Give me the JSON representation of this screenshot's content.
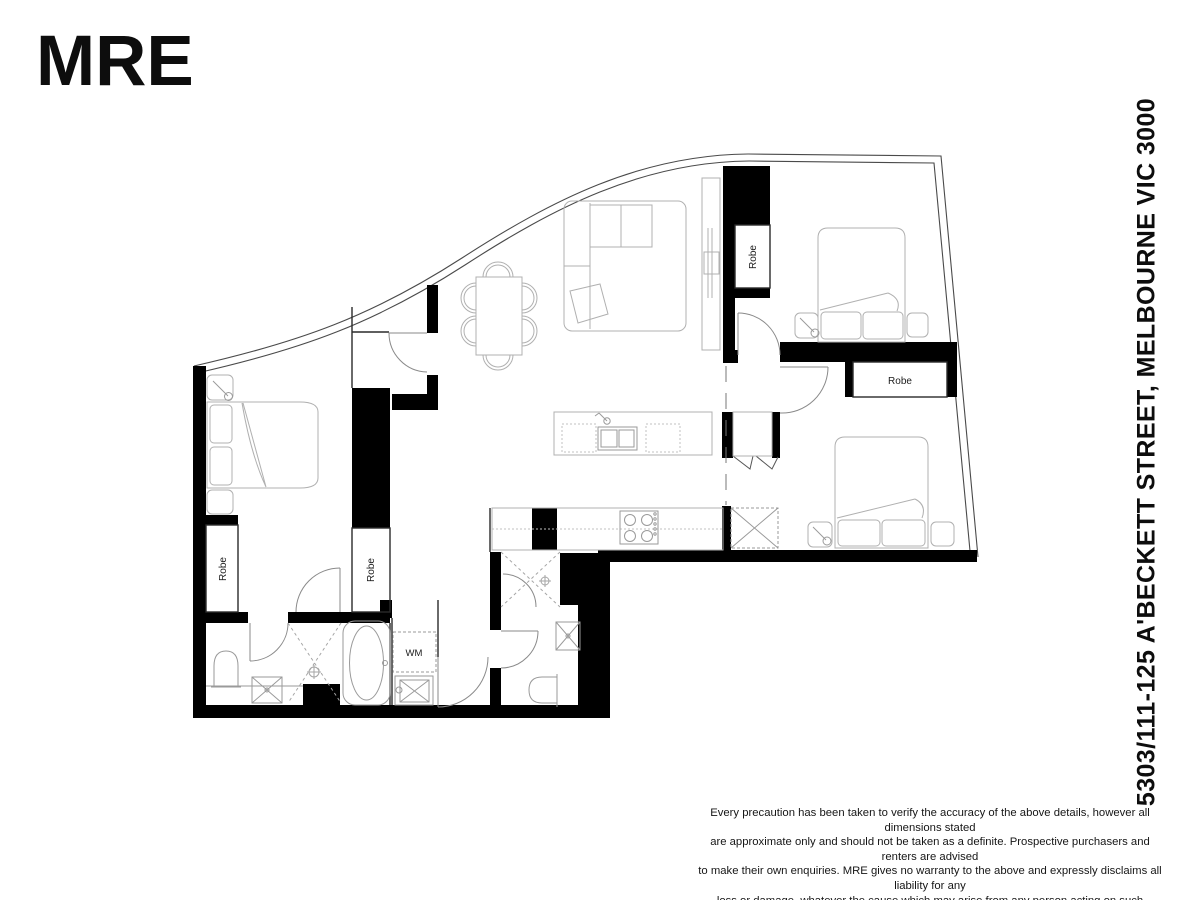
{
  "logo": {
    "text": "MRE"
  },
  "address": {
    "text": "5303/111-125 A'BECKETT STREET, MELBOURNE VIC 3000"
  },
  "floor_plan": {
    "labels": {
      "robe_top": "Robe",
      "robe_right": "Robe",
      "robe_left_outer": "Robe",
      "robe_left_inner": "Robe",
      "wm": "WM"
    }
  },
  "disclaimer": {
    "line1": "Every precaution has been taken to verify the accuracy of the above details, however all dimensions stated",
    "line2": "are approximate only and should not be taken as a definite. Prospective purchasers and renters are advised",
    "line3": "to make their own enquiries. MRE gives no warranty to the above and expressly disclaims all liability for any",
    "line4": "loss or damage, whatever the cause which may arise from any person acting on such statements."
  },
  "colors": {
    "background": "#ffffff",
    "wall": "#000000",
    "glass_line": "#4a4a4a",
    "furniture_line": "#b0b0b0",
    "fixture_line": "#9a9a9a",
    "door_line": "#8a8a8a",
    "text": "#1c1c1c"
  }
}
